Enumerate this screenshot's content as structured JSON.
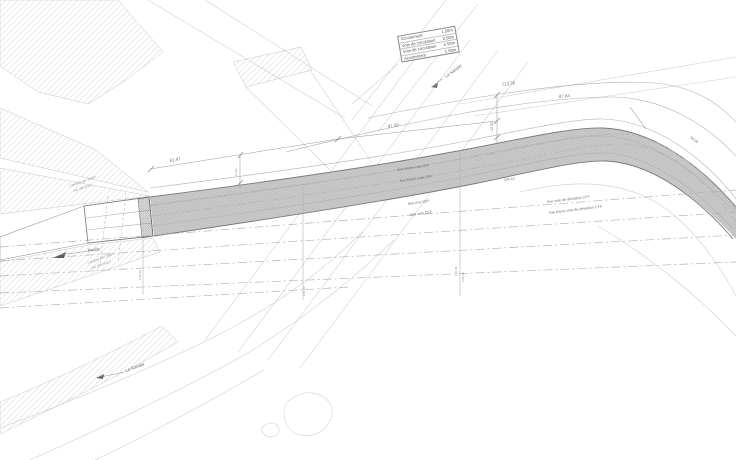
{
  "table": {
    "rows": [
      {
        "label": "Accotement",
        "value": "1.50m"
      },
      {
        "label": "Voie de circulation",
        "value": "3.50m"
      },
      {
        "label": "Voie de circulation",
        "value": "3.50m"
      },
      {
        "label": "Accotement",
        "value": "1.50m"
      }
    ]
  },
  "labels": {
    "river_top": "La Kander",
    "river_bottom": "La Kander",
    "profils": "Profils",
    "conduite_gaz_line1": "Conduite gaz (selon",
    "conduite_gaz_line2": "ind. des prop.)",
    "conduite_eau_line1": "Conduite eau (selon",
    "conduite_eau_line2": "ind. des prop.)",
    "axe_future_voie_a": "Axe future voie CFF",
    "axe_future_voie_b": "Axe future voie CFF",
    "axe_mur": "Axe mur CFF",
    "axe_voie": "Axe voie CFF",
    "axe_voie_deviation": "Axe voie de déviation CFF",
    "axe_future_voie_deviation": "Axe future voie de déviation CFF"
  },
  "dimensions": {
    "d_61_97": "61.97",
    "d_97_39": "97.39",
    "d_712_36": "712.36",
    "d_87_84": "87.84",
    "d_306_63": "306.63",
    "d_56_96": "56.96",
    "d_12_50": "12.50",
    "d_10_90": "10.90",
    "station_a": "102.20",
    "station_b": "102.30",
    "station_c": "102.36",
    "station_d": "102.38"
  },
  "colors": {
    "background": "#ffffff",
    "corridor_fill": "#cbcbcb",
    "road_fill": "#d5d5d5",
    "edge_line": "#7a7a7a",
    "light_line": "#cdcdcd",
    "text": "#6f6f6f"
  }
}
